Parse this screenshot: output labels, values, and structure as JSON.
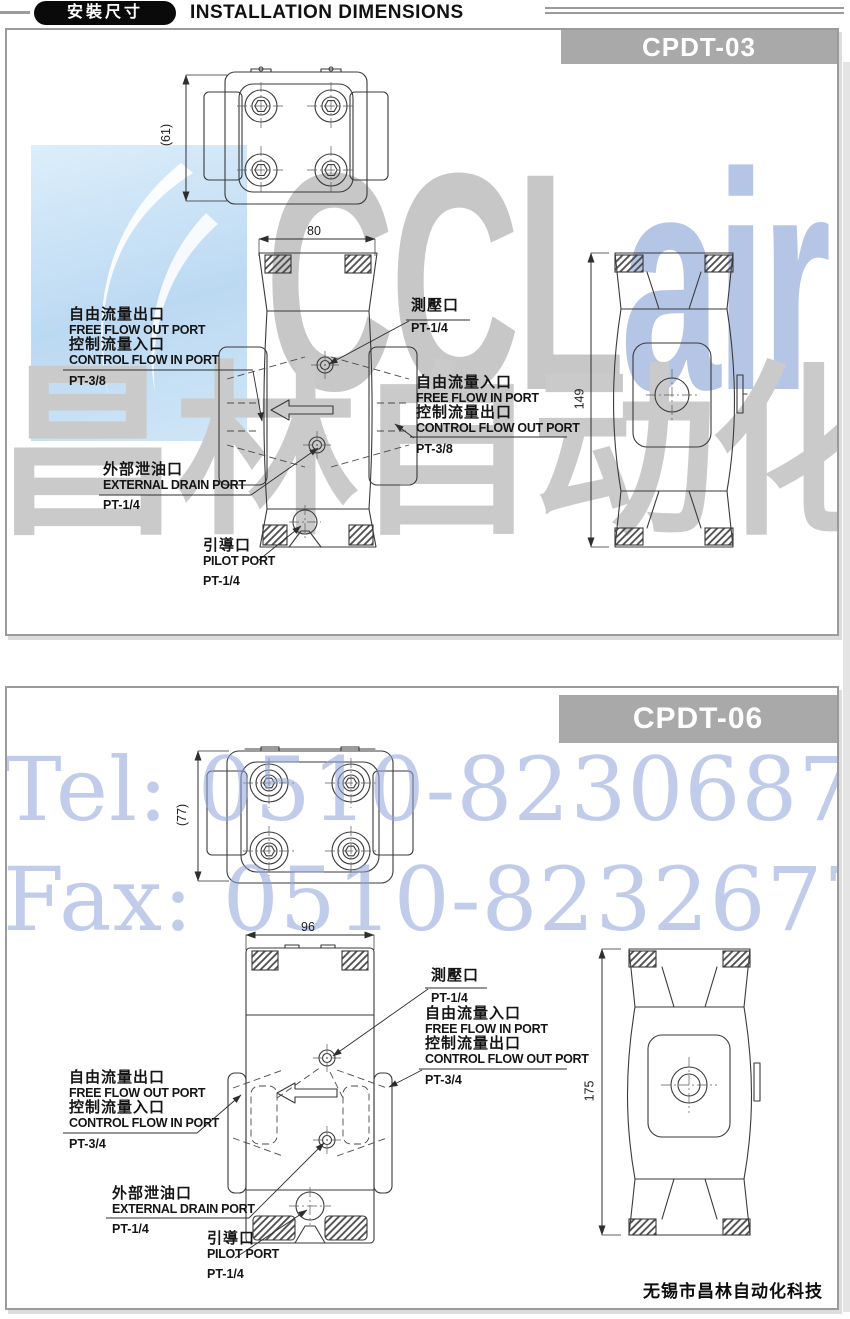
{
  "header": {
    "badge": "安裝尺寸",
    "title": "INSTALLATION DIMENSIONS"
  },
  "watermarks": {
    "brand_prefix": "CCL",
    "brand_suffix": "air",
    "brand_cn": "昌林自动化",
    "tel": "Tel: 0510-82306871",
    "fax": "Fax: 0510-82326771",
    "blue": "#bcd9f2",
    "gray": "#c7c7c7",
    "periwinkle": "#8fa3da"
  },
  "footer": {
    "company": "无锡市昌林自动化科技"
  },
  "panels": [
    {
      "model": "CPDT-03",
      "dimensions": {
        "top_view_height": "(61)",
        "front_view_width": "80",
        "side_view_height": "149"
      },
      "labels": {
        "free_flow_out": {
          "cn1": "自由流量出口",
          "en1": "FREE FLOW OUT PORT",
          "cn2": "控制流量入口",
          "en2": "CONTROL FLOW IN PORT",
          "size": "PT-3/8"
        },
        "gauge": {
          "cn": "測壓口",
          "size": "PT-1/4"
        },
        "free_flow_in": {
          "cn1": "自由流量入口",
          "en1": "FREE FLOW IN PORT",
          "cn2": "控制流量出口",
          "en2": "CONTROL FLOW OUT PORT",
          "size": "PT-3/8"
        },
        "drain": {
          "cn": "外部泄油口",
          "en": "EXTERNAL DRAIN PORT",
          "size": "PT-1/4"
        },
        "pilot": {
          "cn": "引導口",
          "en": "PILOT PORT",
          "size": "PT-1/4"
        }
      }
    },
    {
      "model": "CPDT-06",
      "dimensions": {
        "top_view_height": "(77)",
        "front_view_width": "96",
        "side_view_height": "175"
      },
      "labels": {
        "free_flow_out": {
          "cn1": "自由流量出口",
          "en1": "FREE FLOW OUT PORT",
          "cn2": "控制流量入口",
          "en2": "CONTROL FLOW IN PORT",
          "size": "PT-3/4"
        },
        "gauge": {
          "cn": "測壓口",
          "size": "PT-1/4"
        },
        "free_flow_in": {
          "cn1": "自由流量入口",
          "en1": "FREE FLOW IN PORT",
          "cn2": "控制流量出口",
          "en2": "CONTROL FLOW OUT PORT",
          "size": "PT-3/4"
        },
        "drain": {
          "cn": "外部泄油口",
          "en": "EXTERNAL DRAIN PORT",
          "size": "PT-1/4"
        },
        "pilot": {
          "cn": "引導口",
          "en": "PILOT PORT",
          "size": "PT-1/4"
        }
      }
    }
  ]
}
